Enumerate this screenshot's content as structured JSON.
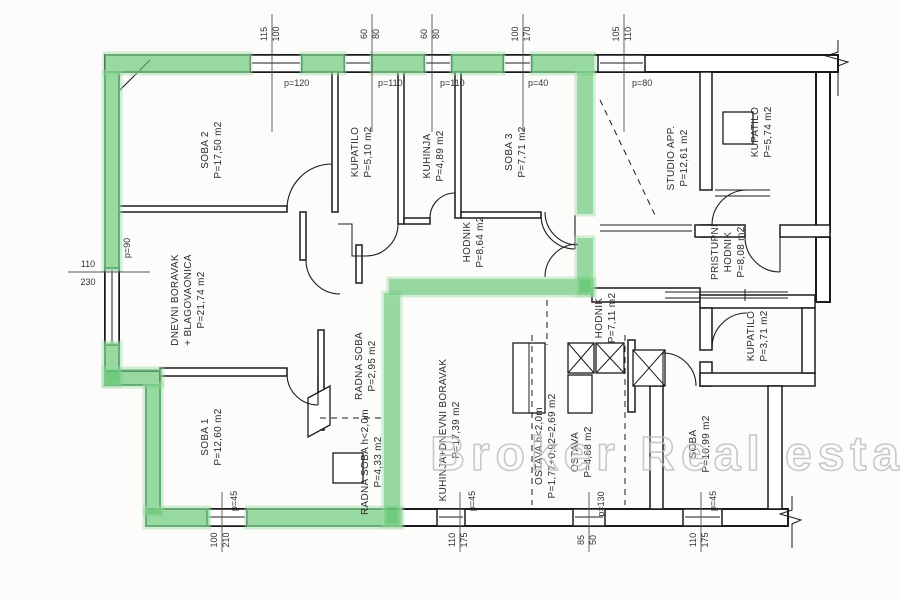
{
  "watermark": "Broker Real estate",
  "rooms": [
    {
      "lines": [
        "SOBA 2",
        "P=17,50 m2"
      ]
    },
    {
      "lines": [
        "KUPATILO",
        "P=5,10 m2"
      ]
    },
    {
      "lines": [
        "KUHINJA",
        "P=4,89 m2"
      ]
    },
    {
      "lines": [
        "SOBA 3",
        "P=7,71 m2"
      ]
    },
    {
      "lines": [
        "STUDIO APP.",
        "P=12,61 m2"
      ]
    },
    {
      "lines": [
        "KUPATILO",
        "P=5,74 m2"
      ]
    },
    {
      "lines": [
        "DNEVNI BORAVAK",
        "+ BLAGOVAONICA",
        "P=21,74 m2"
      ]
    },
    {
      "lines": [
        "HODNIK",
        "P=8,64 m2"
      ]
    },
    {
      "lines": [
        "PRISTUPNI",
        "HODNIK",
        "P=8,08 m2"
      ]
    },
    {
      "lines": [
        "HODNIK",
        "P=7,11 m2"
      ]
    },
    {
      "lines": [
        "KUPATILO",
        "P=3,71 m2"
      ]
    },
    {
      "lines": [
        "SOBA 1",
        "P=12,60 m2"
      ]
    },
    {
      "lines": [
        "RADNA SOBA",
        "P=2,95 m2"
      ]
    },
    {
      "lines": [
        "KUHINJA+DNEVNI BORAVAK",
        "P=17,39 m2"
      ]
    },
    {
      "lines": [
        "RADNA SOBA h<2,0m",
        "P=4,33 m2"
      ]
    },
    {
      "lines": [
        "OSTAVA h<2,0m",
        "P=1,77+0,92=2,69 m2"
      ]
    },
    {
      "lines": [
        "OSTAVA",
        "P=4,68 m2"
      ]
    },
    {
      "lines": [
        "SOBA",
        "P=10,99 m2"
      ]
    }
  ],
  "dimensions": {
    "top": [
      {
        "a": "115",
        "b": "100",
        "p": "p=120"
      },
      {
        "a": "60",
        "b": "80",
        "p": "p=110"
      },
      {
        "a": "60",
        "b": "80",
        "p": "p=110"
      },
      {
        "a": "100",
        "b": "170",
        "p": "p=40"
      },
      {
        "a": "105",
        "b": "110",
        "p": "p=80"
      }
    ],
    "left": [
      {
        "a": "110",
        "b": "230",
        "p": "p=90"
      }
    ],
    "bottom": [
      {
        "a": "100",
        "b": "210",
        "p": "p=45"
      },
      {
        "a": "110",
        "b": "175",
        "p": "p=45"
      },
      {
        "a": "85",
        "b": "50",
        "p": "p=130"
      },
      {
        "a": "110",
        "b": "175",
        "p": "p=45"
      }
    ]
  },
  "colors": {
    "highlight": "#58c169",
    "wall": "#1b1b1b",
    "watermark_stroke": "#bfbfbf"
  }
}
